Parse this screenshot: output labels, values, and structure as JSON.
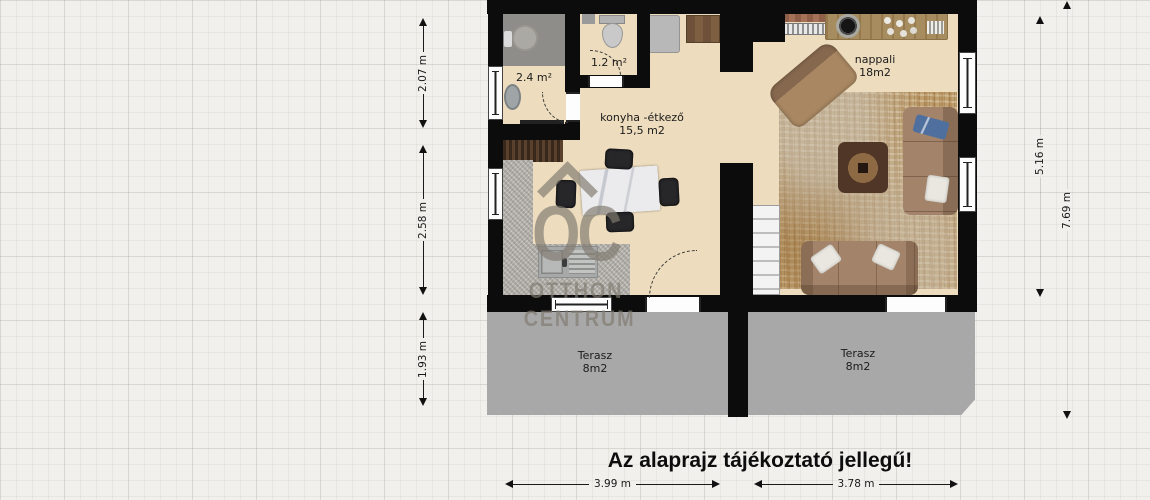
{
  "caption": "Az alaprajz tájékoztató jellegű!",
  "watermark": {
    "logo": "OC",
    "line1": "OTTHON",
    "line2": "CENTRUM"
  },
  "rooms": {
    "bathroom": {
      "area": "2.4 m²"
    },
    "wc": {
      "area": "1.2 m²"
    },
    "kitchen": {
      "name": "konyha -étkező",
      "area": "15,5 m2"
    },
    "living": {
      "name": "nappali",
      "area": "18m2"
    },
    "terrace_left": {
      "name": "Terasz",
      "area": "8m2"
    },
    "terrace_right": {
      "name": "Terasz",
      "area": "8m2"
    }
  },
  "dimensions": {
    "left": [
      "2.07 m",
      "2.58 m",
      "1.93 m"
    ],
    "right": [
      "5.16 m",
      "7.69 m"
    ],
    "bottom": [
      "3.99 m",
      "3.78 m"
    ]
  },
  "colors": {
    "wall": "#0c0c0c",
    "floor": "#eddcbd",
    "terrace": "#a8a8a8",
    "watermark": "#807a70"
  }
}
